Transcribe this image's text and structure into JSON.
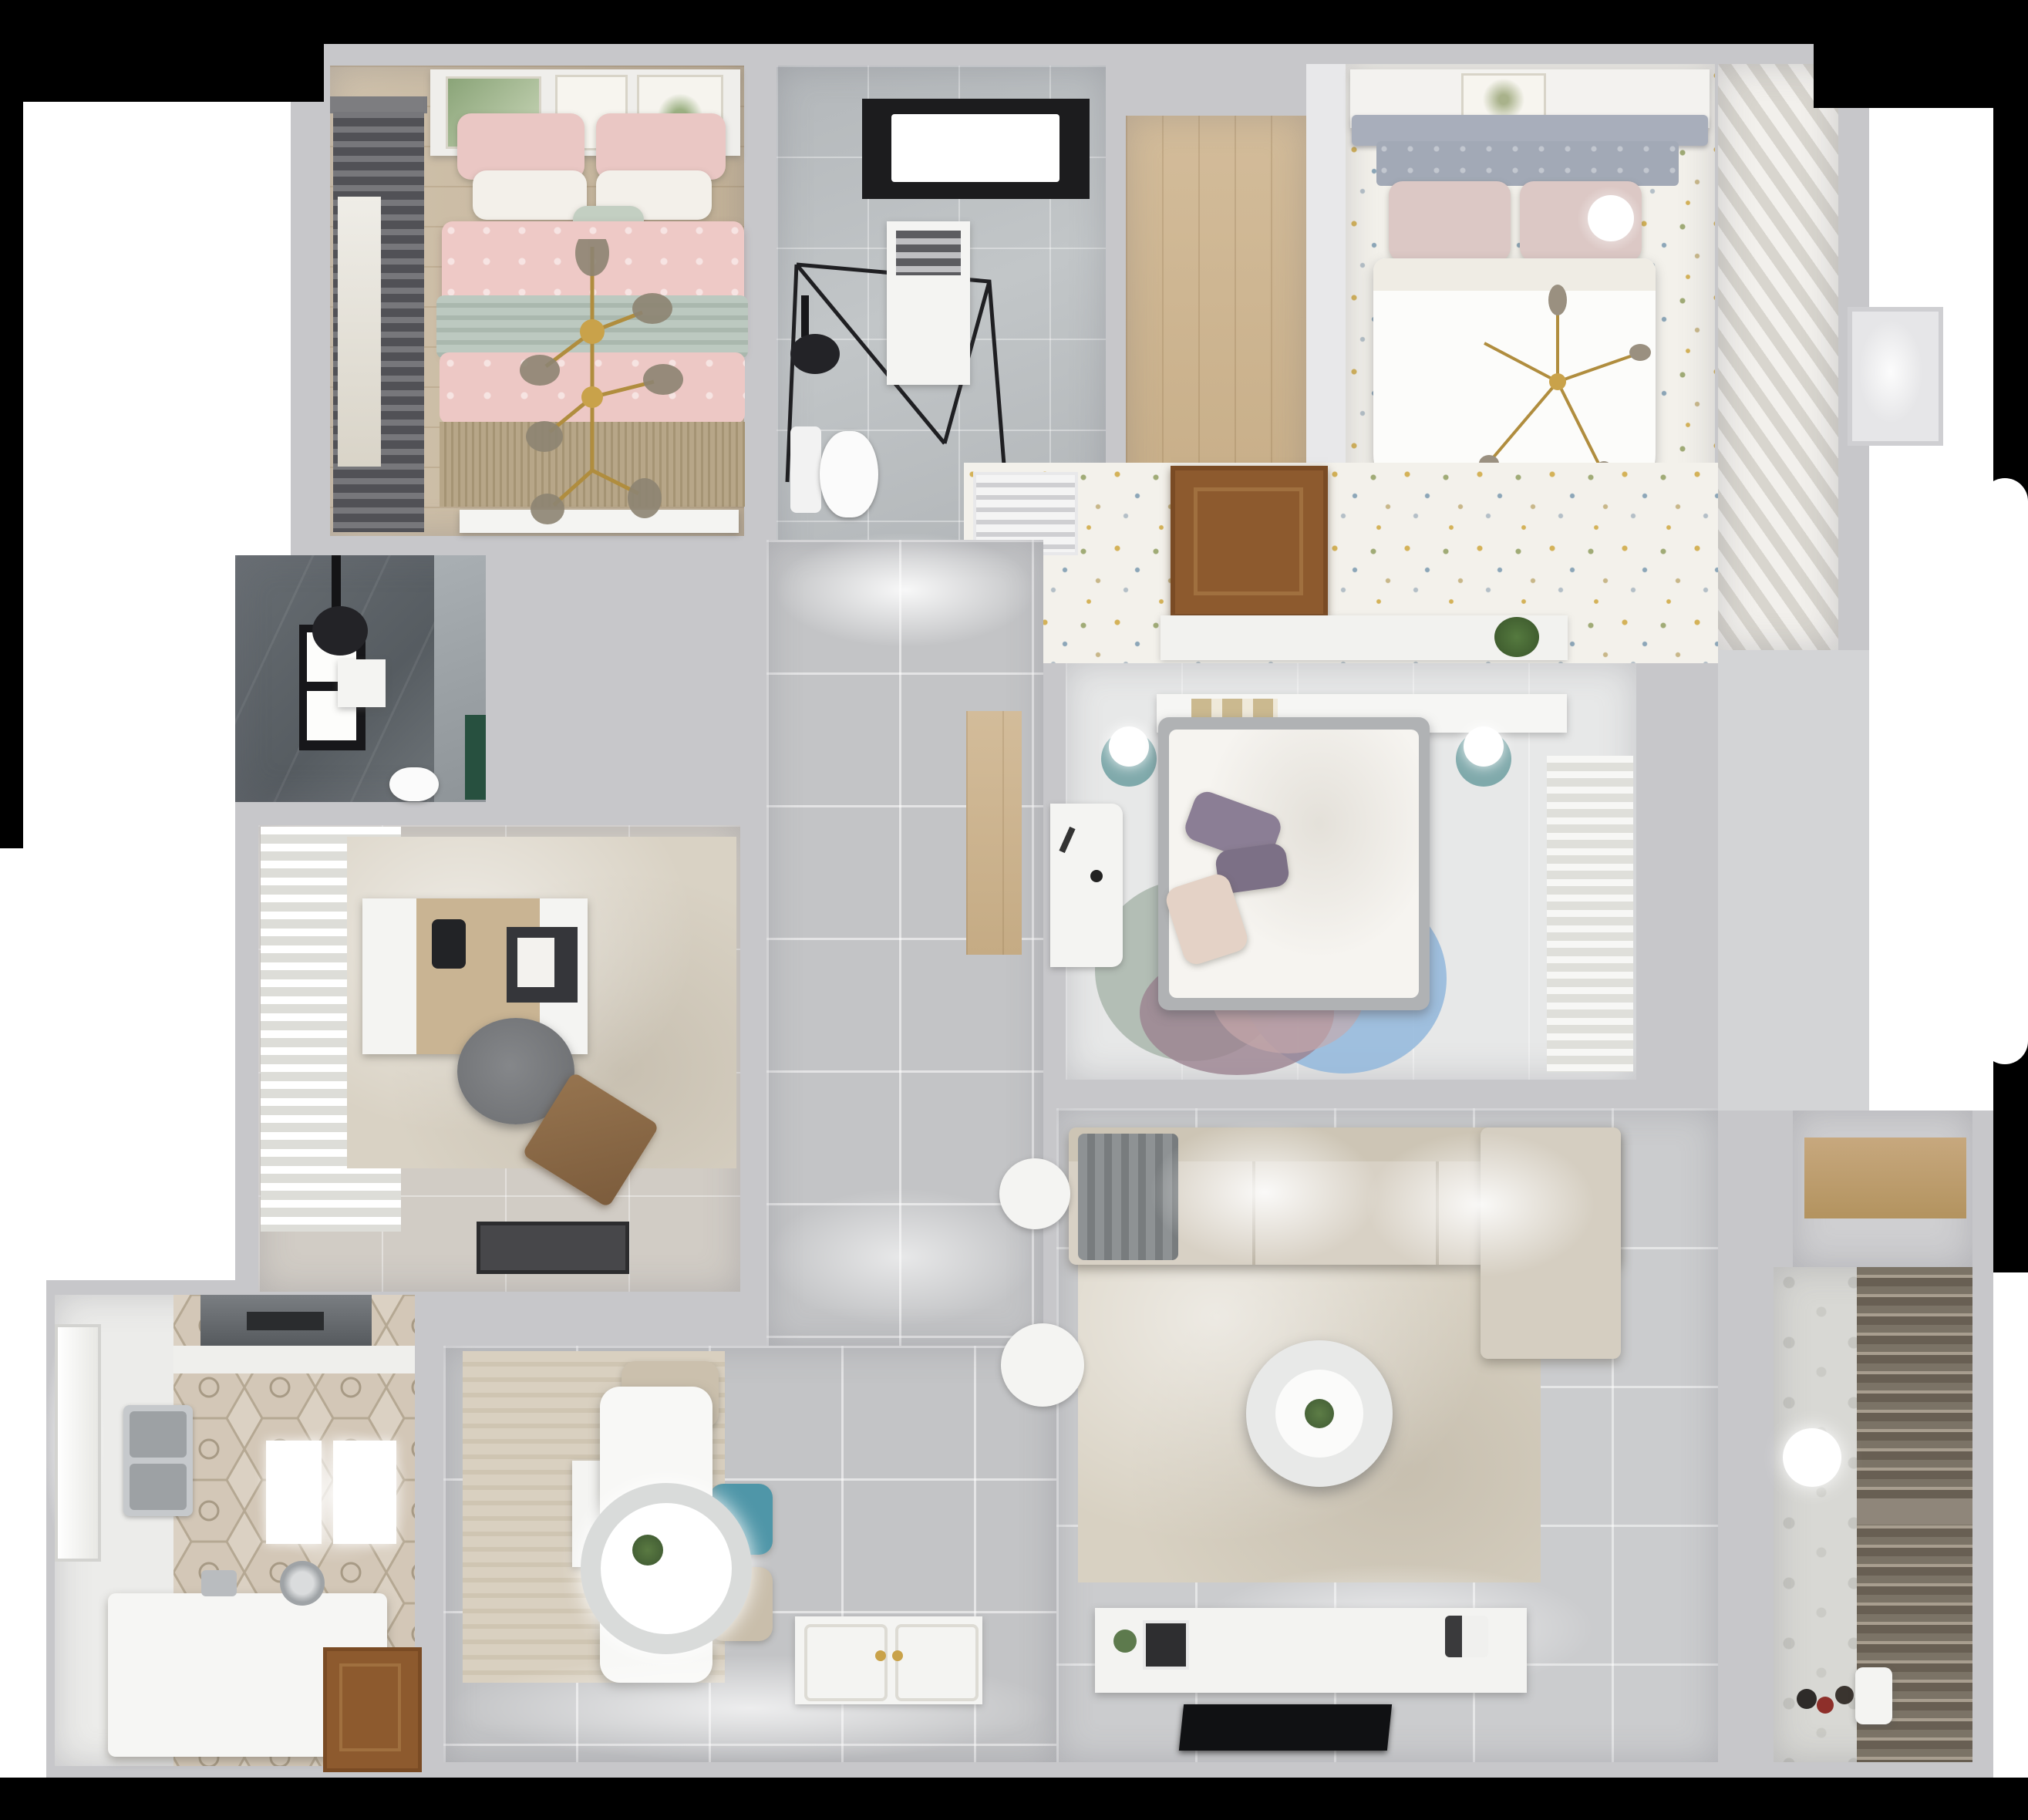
{
  "scene": {
    "title": "3D top-down apartment floor plan render",
    "type": "architectural dollhouse view",
    "background": "#000000",
    "halo": "#ffffff"
  },
  "colors": {
    "wall": "#c7c7ca",
    "hall_tile": "#c3c4c6",
    "living_tile": "#cbccce",
    "speckle_floor": "#f3f1eb",
    "marble": "#b8bcbf",
    "dark_bath": "#5f656a",
    "wood": "#ccb38f",
    "sofa": "#d8d1c5",
    "rug_living": "#d8d1c2",
    "rug_dining": "#d6cdbf",
    "bed_pink": "#eec9c6",
    "throw_sage": "#b8c5bc",
    "duvet_white": "#fcfcfa",
    "headboard_gray": "#a2a9b6",
    "pillow_blush": "#dcc8c5",
    "pillow_purple": "#8b7e95",
    "rug_circle_blue": "#92b7dc",
    "rug_circle_mauve": "#9b8290",
    "rug_circle_sage": "#a9b6ac",
    "chair_teal": "#4f96a8",
    "chair_beige": "#cbc0ad",
    "door_wood": "#8d5a2e",
    "tv_black": "#101113",
    "gold": "#b08d3e",
    "lamp_mint": "#8fb7b9",
    "balcony_blind": "#7b7366"
  },
  "rooms": [
    {
      "id": "bedroom-pink",
      "name": "Bedroom 1 (pink)",
      "furniture": [
        "double bed",
        "pink duvet",
        "sage throw",
        "art frames x3",
        "dark curtains",
        "gold branch chandelier",
        "fringe rug",
        "dresser"
      ]
    },
    {
      "id": "bathroom-main",
      "name": "Bathroom 1",
      "furniture": [
        "walk-in shower",
        "black shower head",
        "window",
        "toilet",
        "white cabinet"
      ]
    },
    {
      "id": "walkin-closet",
      "name": "Walk-in closet",
      "furniture": [
        "wood floor"
      ]
    },
    {
      "id": "bedroom-master",
      "name": "Bedroom 2 (master)",
      "furniture": [
        "bed with gray tufted headboard",
        "white duvet",
        "blush pillows",
        "sphere lamp",
        "gold chandelier",
        "louver wardrobe",
        "ceiling shelf with art"
      ]
    },
    {
      "id": "hall-dotted",
      "name": "Wallpaper hall",
      "furniture": [
        "air vent grille",
        "wood door",
        "plant ledge"
      ]
    },
    {
      "id": "bedroom-center",
      "name": "Bedroom 3",
      "furniture": [
        "headboard shelf with books",
        "mint lamps on teal stools",
        "bed with purple pillows",
        "circle rug",
        "white desk",
        "sheer curtains"
      ]
    },
    {
      "id": "corridor",
      "name": "Corridor",
      "furniture": [
        "gray floor tiles"
      ]
    },
    {
      "id": "study",
      "name": "Study",
      "furniture": [
        "white curtains",
        "desk",
        "desk lamp",
        "tray",
        "gray chair",
        "leather case",
        "doormat",
        "rug"
      ]
    },
    {
      "id": "kitchen",
      "name": "Kitchen / wet room",
      "furniture": [
        "range hood",
        "double sink",
        "hex tile floor",
        "white island tub",
        "faucet",
        "wood door",
        "window"
      ]
    },
    {
      "id": "dining",
      "name": "Dining",
      "furniture": [
        "white table",
        "round pendant lamp",
        "teal chair",
        "beige chairs",
        "bench",
        "rug",
        "carved entry door"
      ]
    },
    {
      "id": "living",
      "name": "Living room",
      "furniture": [
        "L sofa",
        "gray throw",
        "round coffee table",
        "side table",
        "pouf",
        "TV console",
        "flat TV",
        "beige rug"
      ]
    },
    {
      "id": "right-hall",
      "name": "Side hall",
      "furniture": []
    },
    {
      "id": "storage",
      "name": "Storage nook",
      "furniture": [
        "wood shelf"
      ]
    },
    {
      "id": "balcony",
      "name": "Balcony",
      "furniture": [
        "louver blinds",
        "sphere light",
        "toys",
        "small chair",
        "patterned tile"
      ]
    },
    {
      "id": "bathroom-dark",
      "name": "Bathroom 2 (dark)",
      "furniture": [
        "black shower",
        "window",
        "toilet",
        "green glass",
        "white niche"
      ]
    }
  ]
}
